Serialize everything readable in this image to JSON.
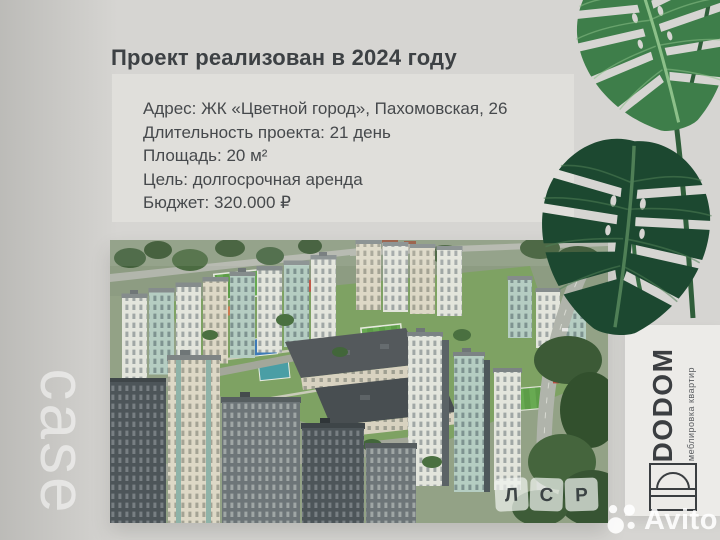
{
  "slide": {
    "title": "Проект реализован в 2024 году",
    "details": {
      "address": "Адрес: ЖК «Цветной город», Пахомовская, 26",
      "duration": "Длительность проекта: 21 день",
      "area": "Площадь: 20 м²",
      "goal": "Цель: долгосрочная аренда",
      "budget": "Бюджет: 320.000 ₽"
    },
    "side_label": "case"
  },
  "brand": {
    "name": "DODOM",
    "tagline": "меблировка квартир"
  },
  "photo": {
    "developer_logo": {
      "letters": [
        "Л",
        "С",
        "Р"
      ]
    }
  },
  "watermark": {
    "text": "Avito"
  },
  "colors": {
    "background": "#d6d5d2",
    "panel": "#e0dfdb",
    "card": "#ecebe8",
    "text_dark": "#3d4144",
    "leaf_light": "#3e7e4a",
    "leaf_dark": "#1c4830"
  }
}
